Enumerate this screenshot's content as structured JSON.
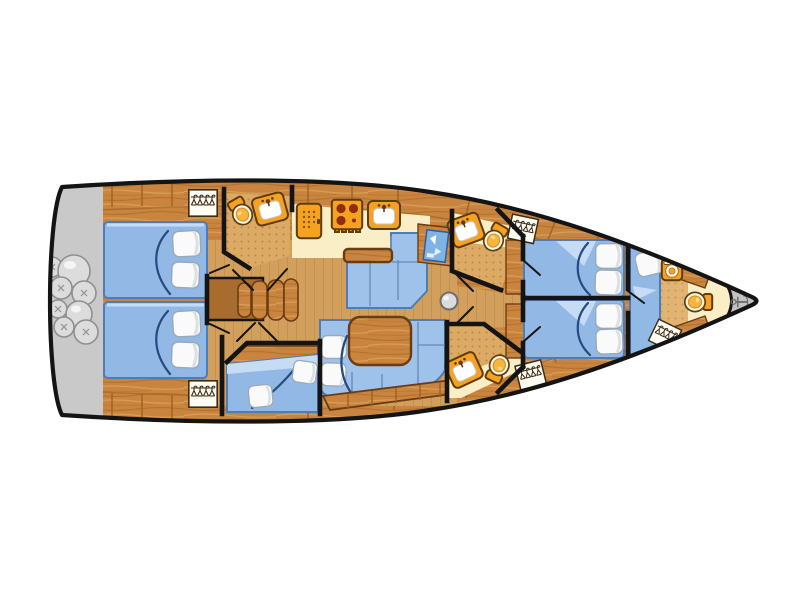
{
  "diagram": {
    "kind": "sailing-yacht-deck-floorplan",
    "orientation": "bow-right-stern-left"
  },
  "colors": {
    "wall": "#141414",
    "wood": "#c9853f",
    "woodStreak": "#a4641f",
    "woodStreakLight": "#e0a75f",
    "stepWood": "#a86c2e",
    "tableEdge": "#6b3c12",
    "tan": "#d2a05c",
    "tanLine": "#bb8842",
    "dotbg": "#dcaa64",
    "dot": "#b8864a",
    "counter": "#faeec6",
    "bed": "#92b9e6",
    "bedEdge": "#4f7cb5",
    "bedLight": "#c6dcf4",
    "settee": "#9fc2ea",
    "cushLine": "#6f93c0",
    "fold": "#26497e",
    "pillow": "#fafafa",
    "pillowShade": "#d3dae1",
    "pillowEdge": "#9aa9b6",
    "orange": "#f6a21f",
    "orangeDeep": "#5f3c0e",
    "burner": "#8f2d0e",
    "white": "#ffffff",
    "mapBlue": "#7fb2e5",
    "transom": "#c9c9c9",
    "transomEdge": "#9b9b9b",
    "fender": "#dcdcdc",
    "fenderHi": "#f7f7f7",
    "fenderEdge": "#8f8f8f",
    "anchorBg": "#c2c2c2",
    "anchorFg": "#6f6f6f",
    "seam": "#9b5f22",
    "hangBg": "#fdfcf3",
    "hangEdge": "#3c2a14"
  },
  "icons": {
    "anchor": {
      "name": "anchor-icon",
      "glyph": "⚓"
    },
    "toilet": {
      "name": "toilet-icon"
    },
    "sink": {
      "name": "sink-icon"
    },
    "stove": {
      "name": "stove-icon"
    },
    "fridge": {
      "name": "fridge-icon"
    },
    "washer": {
      "name": "washing-machine-icon"
    },
    "wardrobe": {
      "name": "wardrobe-hangers-icon"
    },
    "chart": {
      "name": "chart-table-icon"
    },
    "mast": {
      "name": "mast-icon"
    },
    "fender": {
      "name": "fender-icon"
    }
  },
  "areas": [
    "swim-platform",
    "aft-port-cabin",
    "aft-starboard-cabin",
    "aft-heads",
    "galley",
    "salon-dinette",
    "salon-settee",
    "companionway-steps",
    "nav-station",
    "mid-port-heads",
    "mid-starboard-heads",
    "bunk-cabin",
    "forward-port-cabin",
    "forward-starboard-cabin",
    "forward-berth",
    "bow-compartment",
    "anchor-locker"
  ]
}
